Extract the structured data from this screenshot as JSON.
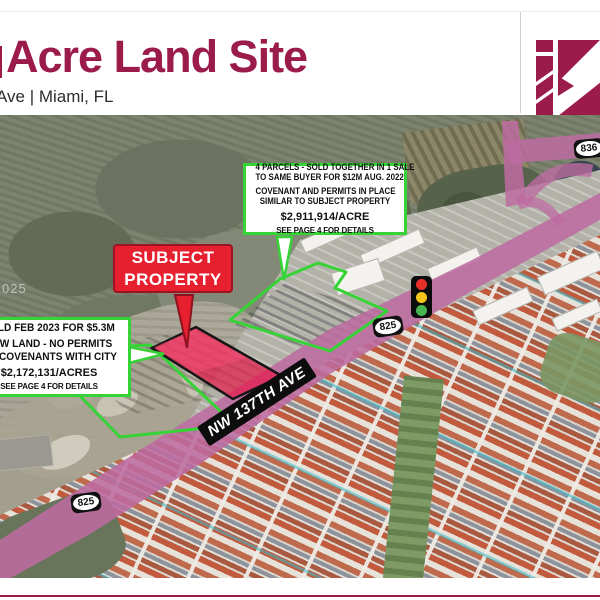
{
  "slide": {
    "header": {
      "title": "Acre Land Site",
      "subtitle": "Ave | Miami, FL"
    },
    "logo": {
      "name": "k-logo",
      "color": "#9b1b4b"
    },
    "map": {
      "watermark": "025",
      "subject_property_label": {
        "line1": "SUBJECT",
        "line2": "PROPERTY"
      },
      "road_label": "NW 137TH AVE",
      "shields": {
        "upper_825": "825",
        "lower_825": "825",
        "route_836": "836"
      },
      "traffic_light": {
        "lights": [
          "red",
          "yellow",
          "green"
        ]
      },
      "callout_parcels": {
        "line1": "4 PARCELS - SOLD TOGETHER IN 1 SALE",
        "line2": "TO SAME BUYER FOR $12M AUG. 2022",
        "line3": "COVENANT AND PERMITS IN PLACE",
        "line4": "SIMILAR TO SUBJECT PROPERTY",
        "price": "$2,911,914/ACRE",
        "footnote": "SEE PAGE 4 FOR DETAILS"
      },
      "callout_sold": {
        "line1": "SOLD FEB 2023 FOR $5.3M",
        "line2": "RAW LAND - NO PERMITS",
        "line3": "OR COVENANTS WITH CITY",
        "price": "$2,172,131/ACRES",
        "footnote": "SEE PAGE 4 FOR DETAILS"
      }
    },
    "colors": {
      "brand": "#9b1b4b",
      "annotation_green": "#36d336",
      "subject_red": "#e6202e",
      "road_pink": "#bd6ba1"
    }
  }
}
